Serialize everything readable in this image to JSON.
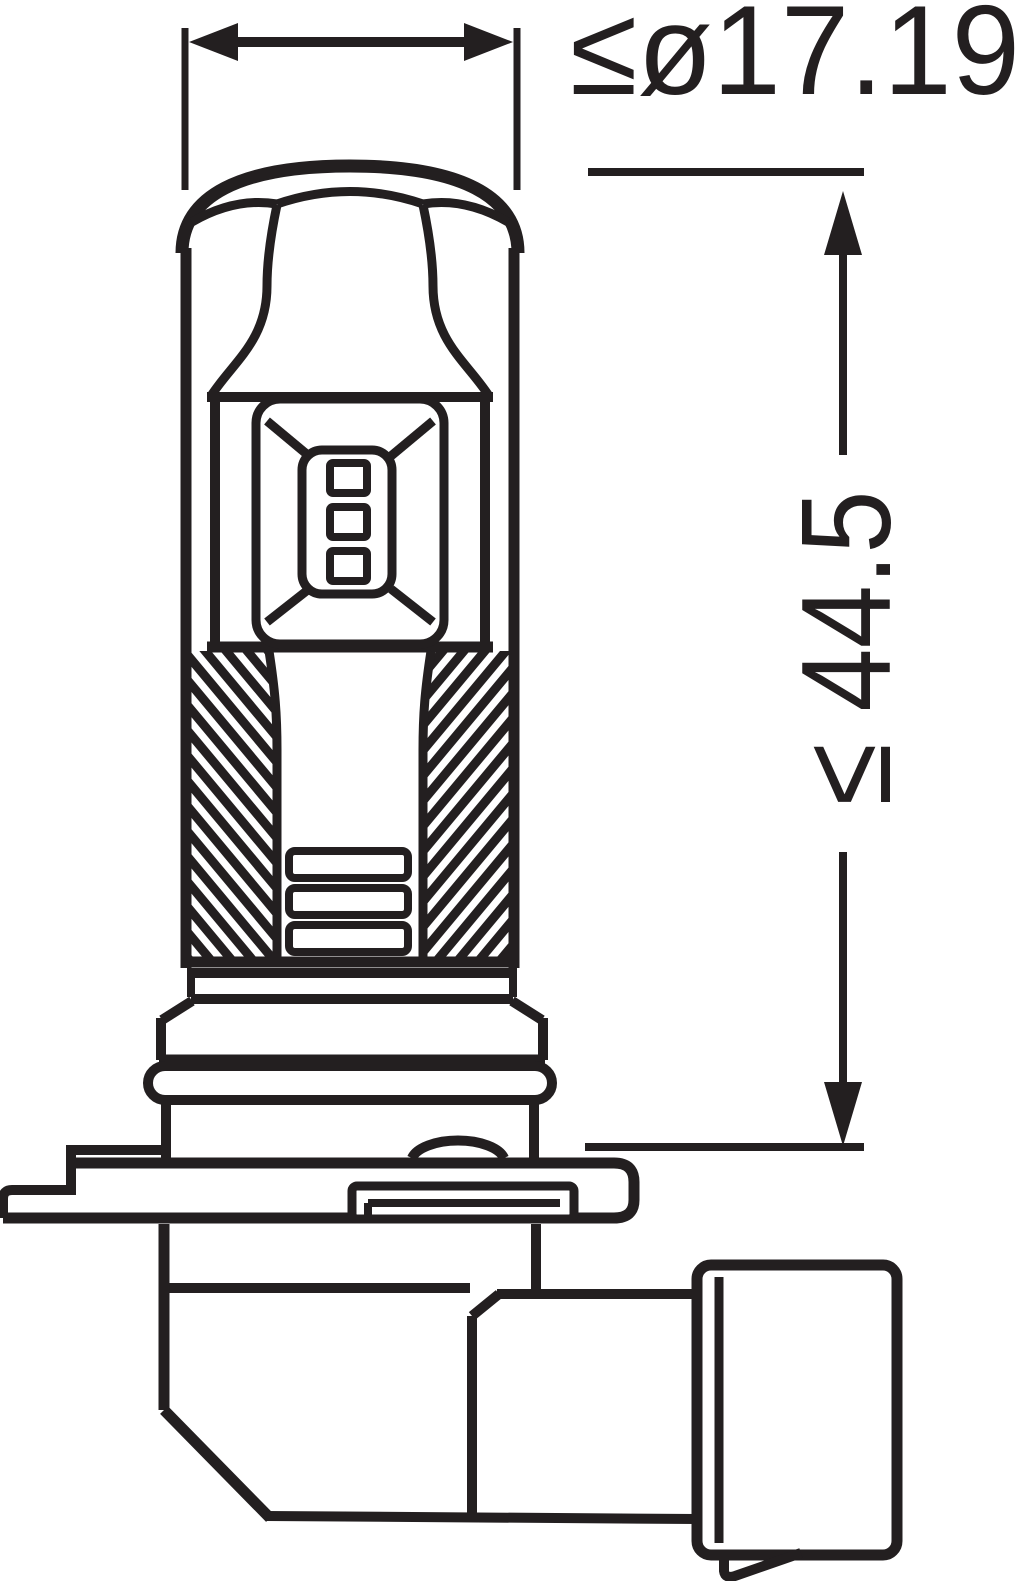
{
  "diagram": {
    "type": "technical-line-drawing",
    "subject": "automotive LED bulb side profile with dimension callouts",
    "background_color": "#ffffff",
    "line_color": "#231f20",
    "dimensions": {
      "diameter_label": "≤ø17.19",
      "length_label": "≤ 44.5"
    }
  }
}
